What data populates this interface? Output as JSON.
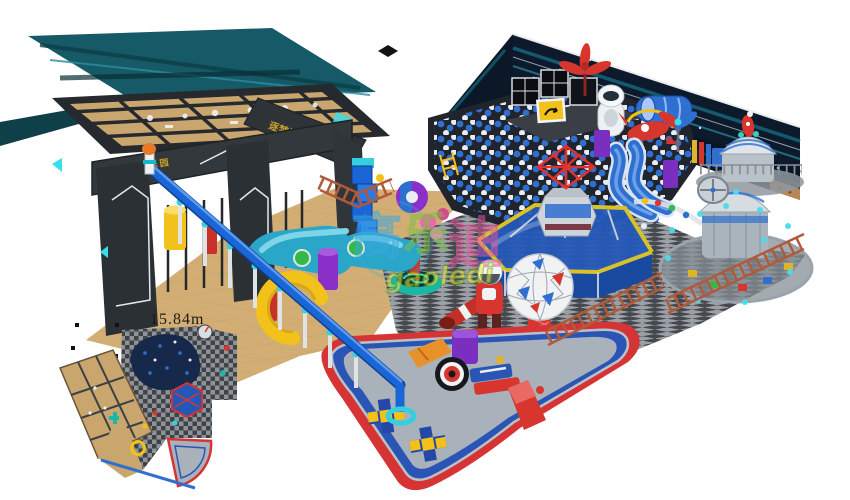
{
  "render": {
    "dimension_label": "15.84m",
    "gate": {
      "left_sign": "YIQ乐园",
      "right_sign": "逐梦站台"
    },
    "watermark": {
      "cn_chars": [
        "高",
        "乐",
        "迪"
      ],
      "en": "gaoledi"
    },
    "colors": {
      "wall_navy": "#0c1a2c",
      "wall_teal": "#155a66",
      "gate_charcoal": "#2e3338",
      "floor_tan": "#d2ae74",
      "checker_light": "#9aa0a6",
      "checker_dark": "#45494e",
      "ball_blue": "#2f6fd0",
      "slide_blue": "#1a66d6",
      "fence_orange": "#b05a3c",
      "fan_red": "#d63434",
      "fan_blue": "#2b55b5",
      "fan_floor": "#a9b2ba",
      "accent_yellow": "#f2c21a",
      "dome_gray": "#cdd4da",
      "hex_blue": "#2458b8",
      "diamond_red": "#e03030",
      "sign_gold": "#c9a227",
      "watermark_blue": "#3aa7e0",
      "watermark_green": "#7ac143",
      "watermark_pink": "#e8559b",
      "watermark_yellow": "#f5e33a"
    }
  }
}
